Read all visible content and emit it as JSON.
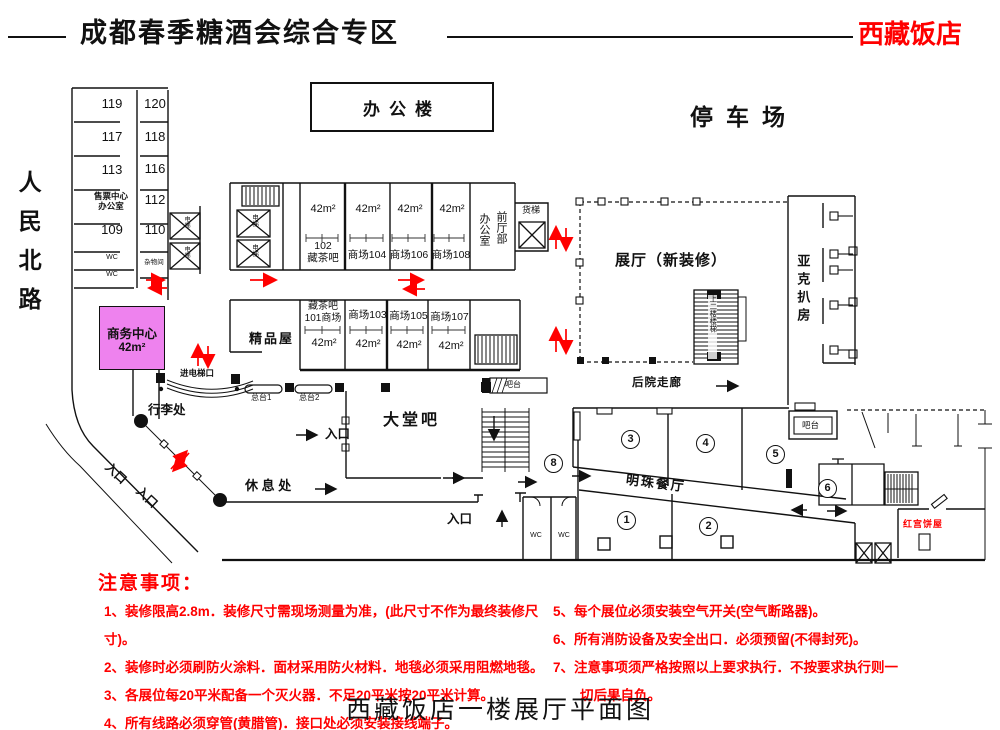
{
  "colors": {
    "accent_red": "#ff0000",
    "business_center_fill": "#ee82ee",
    "line": "#111111"
  },
  "header": {
    "title": "成都春季糖酒会综合专区",
    "hotel_name": "西藏饭店"
  },
  "street_name": "人民北路",
  "landmarks": {
    "office_building": "办公楼",
    "parking_lot": "停车场"
  },
  "left_wing": {
    "rooms_left": [
      "119",
      "117",
      "113",
      "109"
    ],
    "rooms_right": [
      "120",
      "118",
      "116",
      "112",
      "110"
    ],
    "ticket_office": "售票中心\n办公室",
    "wc": "WC",
    "storage": "杂物间",
    "elevator": "电梯"
  },
  "booths": {
    "area": "42m²",
    "top_row": [
      "102\n藏茶吧",
      "商场104",
      "商场106",
      "商场108"
    ],
    "bottom_row": [
      "藏茶吧\n101商场",
      "商场103",
      "商场105",
      "商场107"
    ]
  },
  "facilities": {
    "business_center": "商务中心",
    "business_center_area": "42m²",
    "boutique": "精品屋",
    "elevator_entrance": "进电梯口",
    "front_desk_1": "总台1",
    "front_desk_2": "总台2",
    "luggage_point": "行李处",
    "rest_area": "休 息 处",
    "entrance": "入口",
    "lobby_bar": "大堂吧",
    "bar_counter": "吧台",
    "front_office_left": "办公室",
    "front_office_right": "前厅部",
    "freight_elevator": "货梯",
    "exhibition_hall": "展厅（新装修）",
    "stairs_label": "上二楼楼梯",
    "backyard_corridor": "后院走廊",
    "yake_grill_room": "亚克扒房",
    "pearl_restaurant": "明珠餐厅",
    "red_palace_bakery": "红宫饼屋",
    "wc": "WC"
  },
  "zones": [
    "1",
    "2",
    "3",
    "4",
    "5",
    "6",
    "8"
  ],
  "notes": {
    "title": "注意事项：",
    "left": "1、装修限高2.8m．装修尺寸需现场测量为准，(此尺寸不作为最终装修尺寸)。\n2、装修时必须刷防火涂料．面材采用防火材料．地毯必须采用阻燃地毯。\n3、各展位每20平米配备一个灭火器．不足20平米按20平米计算。\n4、所有线路必须穿管(黄腊管)．接口处必须安装接线端子。",
    "right": "5、每个展位必须安装空气开关(空气断路器)。\n6、所有消防设备及安全出口．必须预留(不得封死)。\n7、注意事项须严格按照以上要求执行．不按要求执行则一\n　　切后果自负。"
  },
  "footer_title": "西藏饭店一楼展厅平面图"
}
